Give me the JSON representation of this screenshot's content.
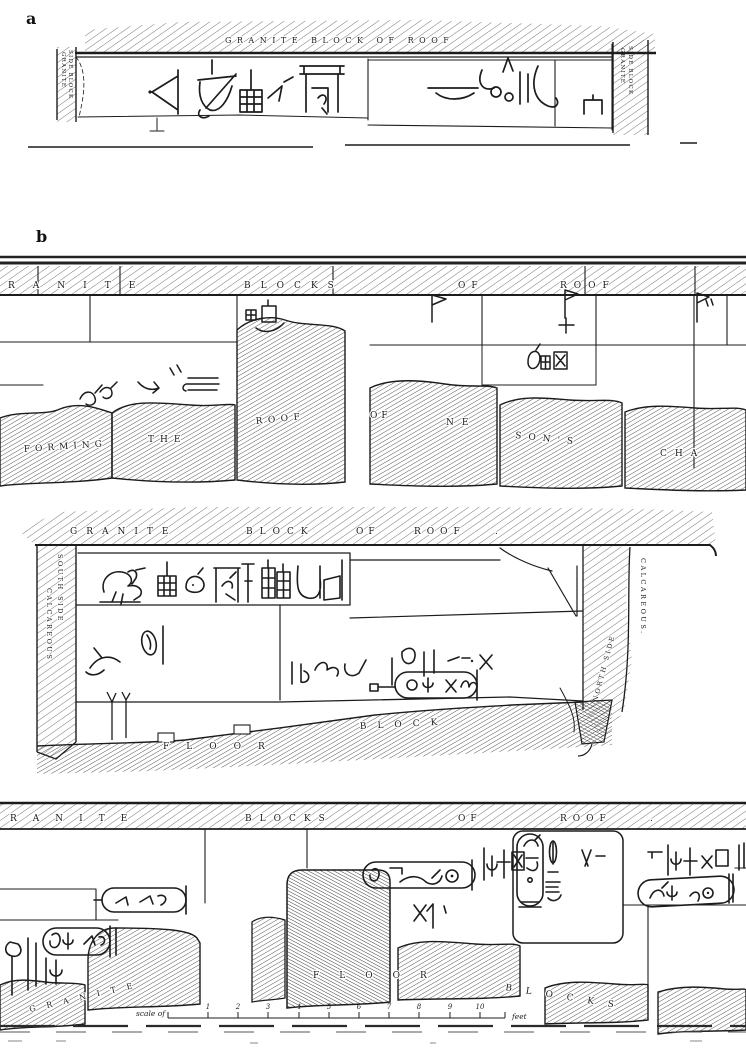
{
  "figure": {
    "label_a": "a",
    "label_b": "b"
  },
  "panel_a": {
    "roof_label": "GRANITE BLOCK OF ROOF",
    "left_side_line1": "GRANITE",
    "left_side_line2": "SIDE BLOCK",
    "right_side_line1": "GRANITE",
    "right_side_line2": "SIDE BLOCK"
  },
  "panel_b": {
    "roof_words": [
      "RANITE",
      "BLOCKS",
      "OF",
      "ROOF"
    ],
    "wall_words": [
      "FORMING",
      "THE",
      "ROOF",
      "OF",
      "NE",
      "SON'S",
      "CHA"
    ]
  },
  "panel_c": {
    "roof_words": [
      "GRANITE",
      "BLOCK",
      "OF",
      "ROOF",
      "."
    ],
    "left_label_line1": "SOUTH SIDE",
    "left_label_line2": "CALCAREOUS",
    "right_label_line1": "NORTH SIDE",
    "right_label_line2": "CALCAREOUS.",
    "floor_words": [
      "FLOOR",
      "BLOCK"
    ]
  },
  "panel_d": {
    "roof_words": [
      "RANITE",
      "BLOCKS",
      "OF",
      "ROOF",
      "."
    ],
    "floor_words": [
      "GRANITE",
      "FLOOR",
      "BLOCKS"
    ],
    "scale_bar": {
      "prefix": "scale of",
      "numbers": [
        "1",
        "2",
        "3",
        "4",
        "5",
        "6",
        "7",
        "8",
        "9",
        "10"
      ],
      "unit": "feet"
    }
  },
  "colors": {
    "ink": "#1c1c1c",
    "paper": "#ffffff"
  }
}
